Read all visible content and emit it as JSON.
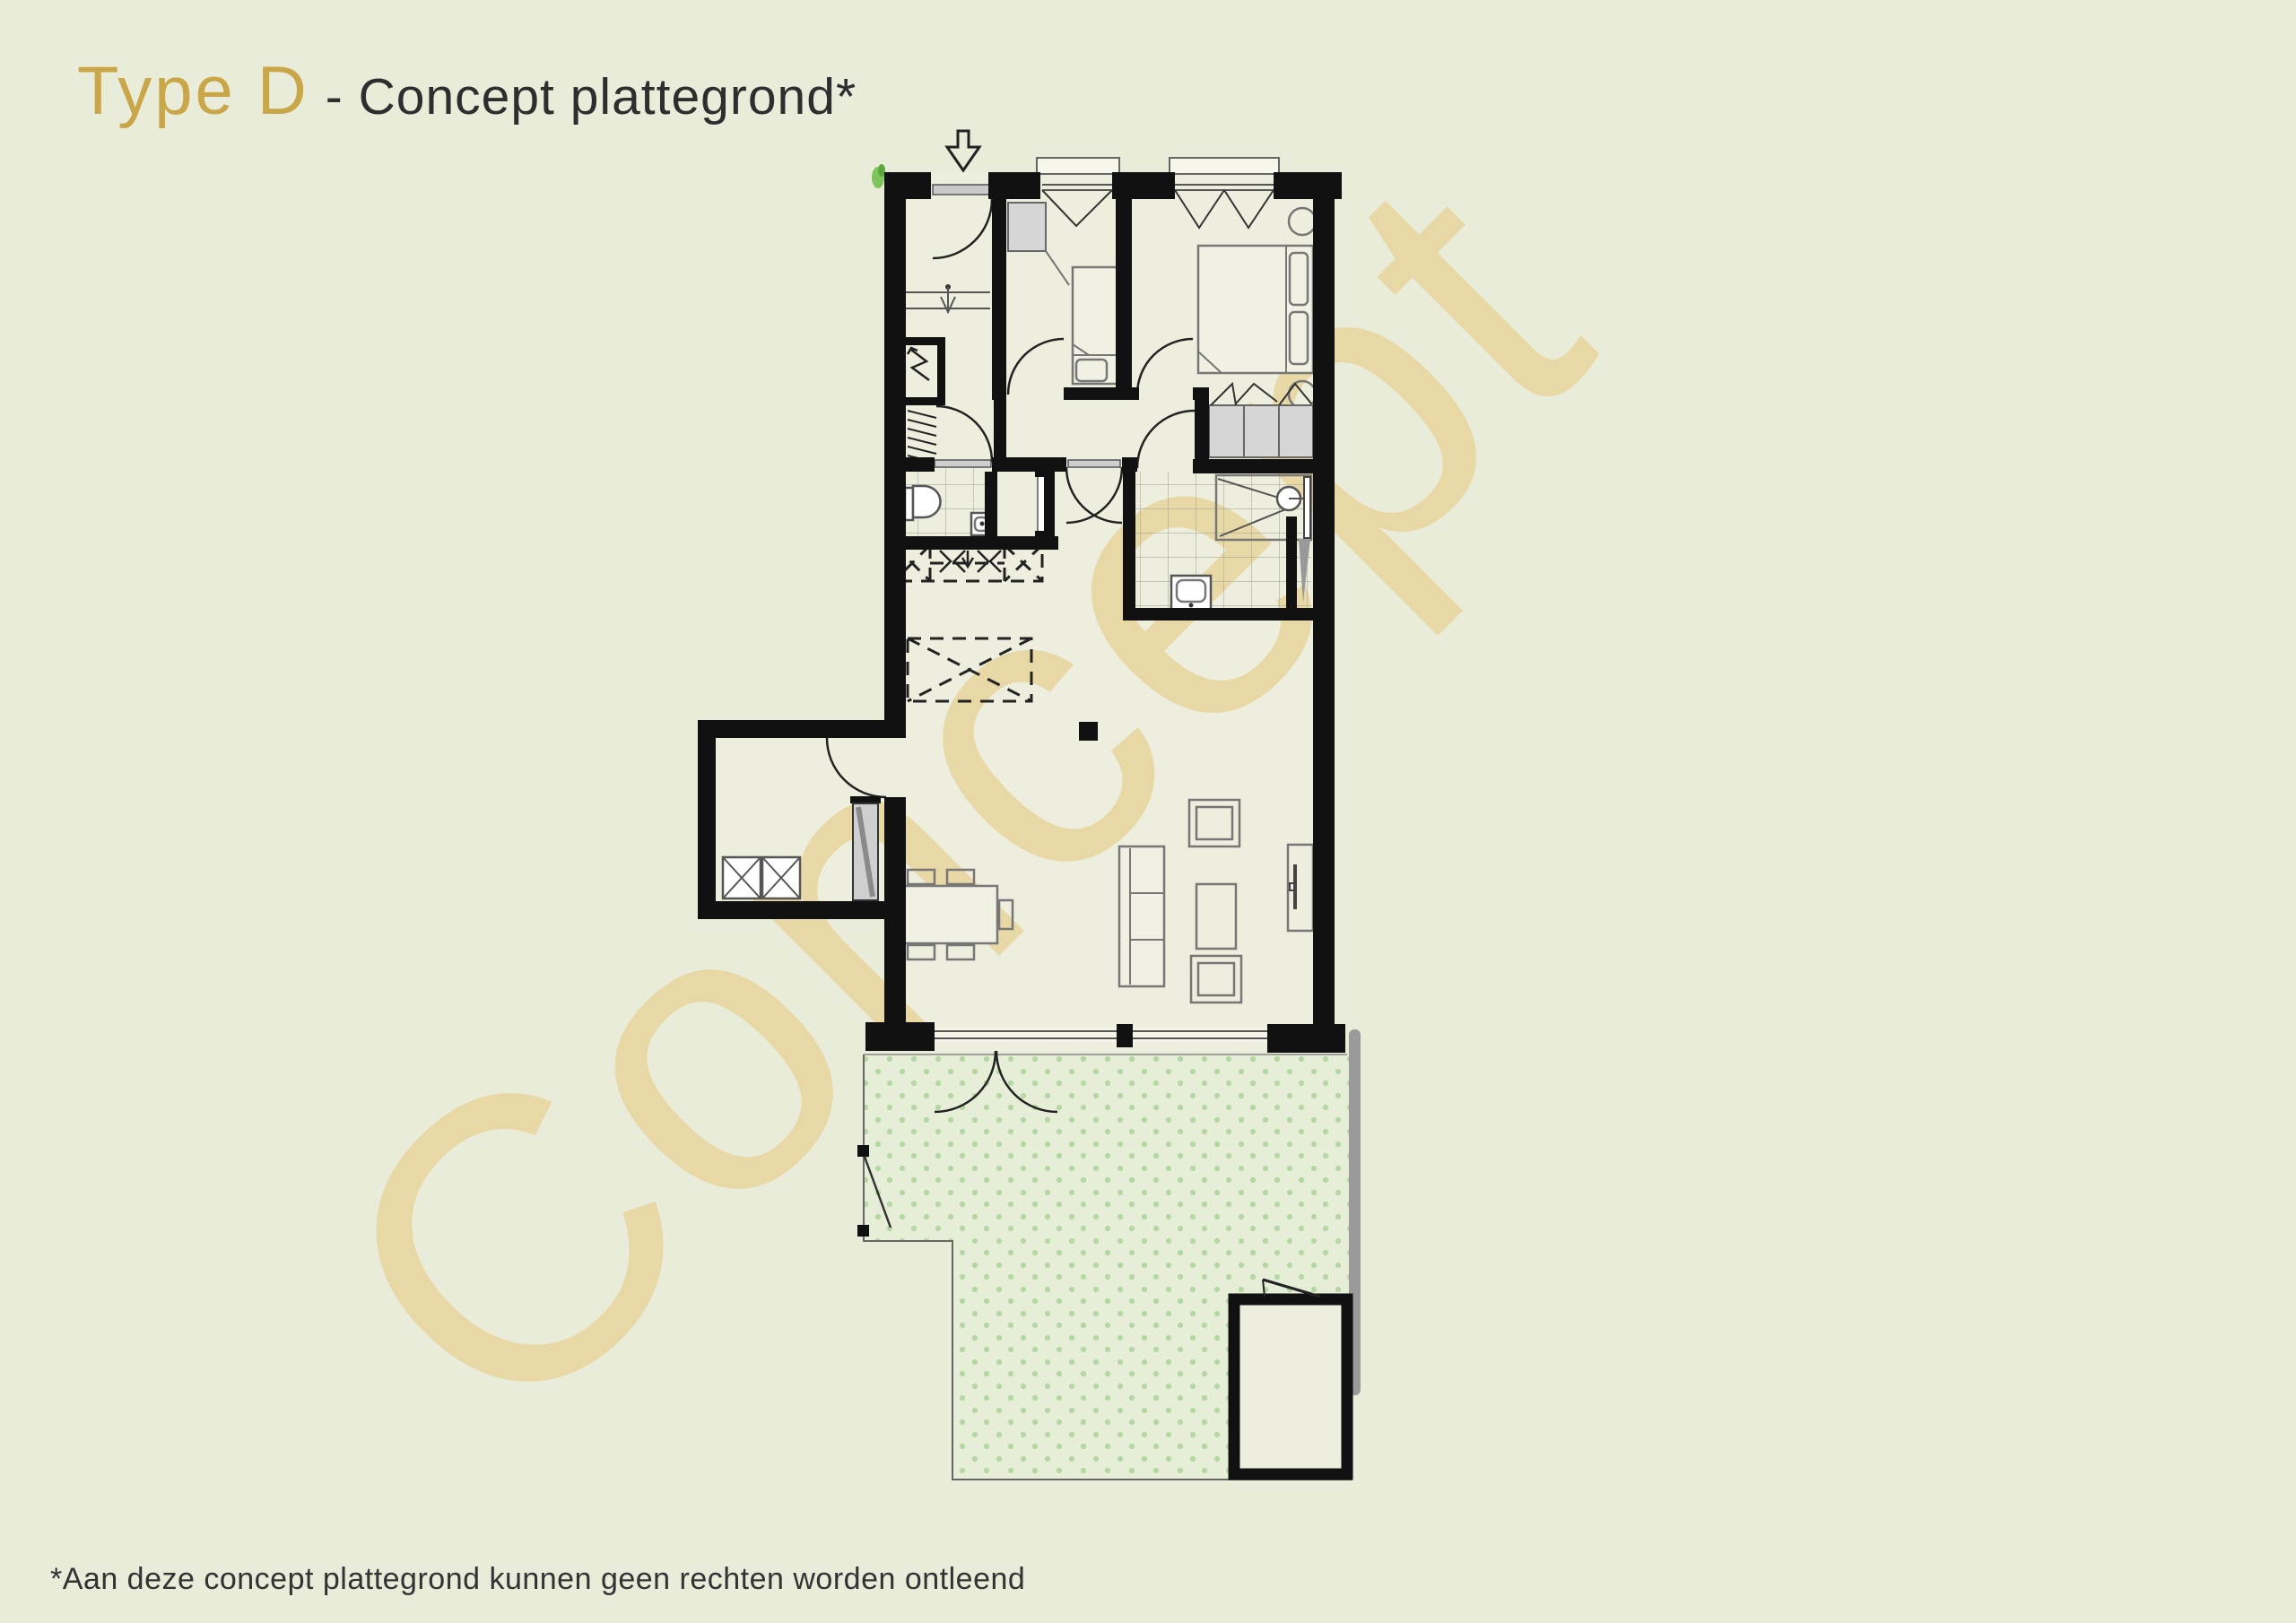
{
  "header": {
    "title_accent": "Type D",
    "title_rest": "- Concept plattegrond*"
  },
  "watermark": {
    "text": "Concept"
  },
  "footer": {
    "disclaimer": "*Aan deze concept plattegrond kunnen geen rechten worden ontleend"
  },
  "floor_plan": {
    "type": "apartment-concept-floor-plan",
    "features": [
      "entrance-arrow",
      "entrance-door",
      "entry-hall-step",
      "meter-cupboard",
      "coat-rack",
      "bedroom-1",
      "bedroom-1-bed",
      "bedroom-1-closet",
      "bedroom-1-window",
      "bedroom-2",
      "bedroom-2-double-bed",
      "bedroom-2-side-tables",
      "bedroom-2-window",
      "hall-wardrobe",
      "toilet-room",
      "toilet",
      "corner-basin",
      "hall-closet",
      "bathroom",
      "shower",
      "washbasin",
      "technical-shaft",
      "concept-kitchen-dashed-units",
      "concept-kitchen-island",
      "living-room",
      "dining-table",
      "dining-chairs",
      "sofa",
      "armchairs",
      "coffee-table",
      "tv-cabinet",
      "column",
      "exterior-storage",
      "washer-dryer",
      "storage-cabinet",
      "french-doors",
      "fixed-glazing",
      "terrace",
      "terrace-gate",
      "garden-shed",
      "shed-door",
      "plant"
    ]
  },
  "colors": {
    "background": "#eaecda",
    "title_accent": "#c9a748",
    "title_text": "#2e2e2e",
    "wall": "#111111",
    "watermark": "#e8d8a6",
    "floor": "#edeedd",
    "terrace_fill": "#e6eed7",
    "terrace_dot": "#b5d7a3",
    "fixture_gray": "#d6d6d6",
    "shadow_gray": "#9a9a9a",
    "plant_green": "#7fc45c"
  }
}
